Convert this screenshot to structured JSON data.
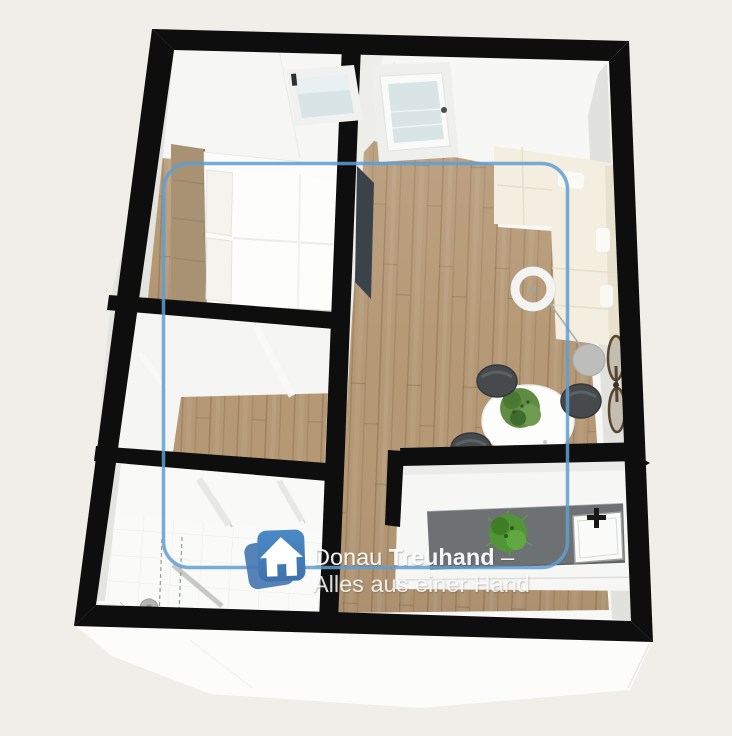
{
  "watermark": {
    "logo": {
      "icon": "house-icon"
    },
    "line1": {
      "regular": "Donau ",
      "bold": "Treuhand",
      "suffix": " –"
    },
    "line2": "Alles aus einer Hand"
  },
  "colors": {
    "background": "#efeee9",
    "wall": "#0e0e0e",
    "floor_wood": "#b59875",
    "overlay_blue": "#5f9dd1",
    "brand_blue": "#4b8ac6",
    "brand_blue_dark": "#3e71ac",
    "brand_blue_back": "#4778b1",
    "counter": "#6e7173",
    "sofa_cream": "#f3eedf",
    "chair_gray": "#464a4d",
    "plant_green": "#4f9733",
    "glass": "#d8e4e6",
    "headboard_tan": "#a99273",
    "watermark_text": "#ffffff"
  },
  "scene": {
    "type": "3d-floor-plan",
    "rooms": [
      {
        "name": "bedroom",
        "items": [
          "double-bed",
          "window"
        ]
      },
      {
        "name": "hallway",
        "items": [
          "open-door"
        ]
      },
      {
        "name": "bathroom",
        "items": [
          "shower",
          "towel-rails"
        ]
      },
      {
        "name": "living-dining",
        "items": [
          "entry-door",
          "tv",
          "sofa",
          "floor-lamp",
          "arc-lamp",
          "dining-table",
          "chairs",
          "plant",
          "bicycle"
        ]
      },
      {
        "name": "kitchen",
        "items": [
          "counter",
          "sink",
          "faucet",
          "plant"
        ]
      }
    ],
    "overlay": "selection-frame"
  }
}
